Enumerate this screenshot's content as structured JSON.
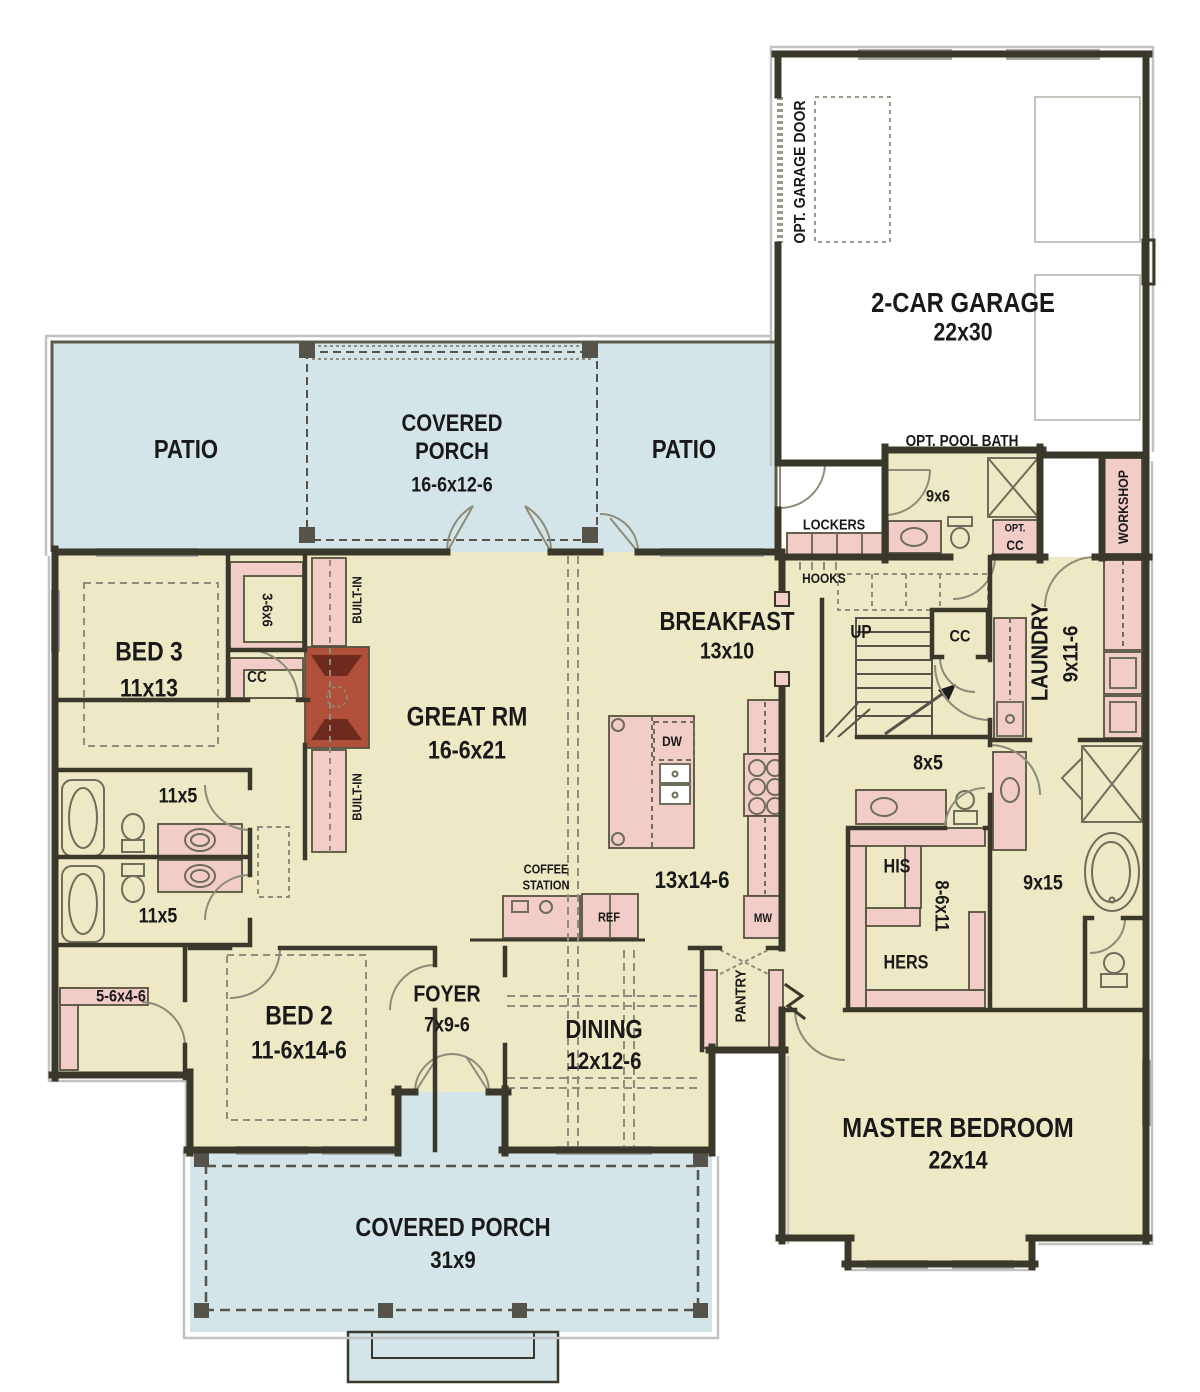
{
  "palette": {
    "floor": "#ece9c4",
    "porch_blue": "#d3e5e9",
    "fixture_pink": "#f2cdc7",
    "brick_red": "#b0503a",
    "brick_dark": "#6e2a1c",
    "wall": "#3a382a",
    "window_gray": "#a9a9a9",
    "trim_gray": "#c2c2c2",
    "label": "#191919"
  },
  "labels": {
    "opt_garage_door": "OPT. GARAGE DOOR",
    "garage": "2-CAR GARAGE",
    "garage_dims": "22x30",
    "patio_left": "PATIO",
    "patio_right": "PATIO",
    "porch_top_1": "COVERED",
    "porch_top_2": "PORCH",
    "porch_top_dims": "16-6x12-6",
    "pool_bath": "OPT. POOL BATH",
    "pool_bath_dims": "9x6",
    "lockers": "LOCKERS",
    "opt_small": "OPT.",
    "opt_cc": "CC",
    "hooks": "HOOKS",
    "workshop": "WORKSHOP",
    "breakfast": "BREAKFAST",
    "breakfast_dims": "13x10",
    "up": "UP",
    "stair_cc": "CC",
    "laundry": "LAUNDRY",
    "laundry_dims": "9x11-6",
    "closet_3_6": "3-6x6",
    "bed3": "BED 3",
    "bed3_dims": "11x13",
    "bed3_cc": "CC",
    "builtin_top": "BUILT-IN",
    "builtin_bottom": "BUILT-IN",
    "great": "GREAT RM",
    "great_dims": "16-6x21",
    "bath_upper_dims": "11x5",
    "bath_lower_dims": "11x5",
    "closet_5_6": "5-6x4-6",
    "bed2": "BED 2",
    "bed2_dims": "11-6x14-6",
    "foyer": "FOYER",
    "foyer_dims": "7x9-6",
    "dining": "DINING",
    "dining_dims": "12x12-6",
    "coffee_1": "COFFEE",
    "coffee_2": "STATION",
    "ref": "REF",
    "kitchen_dims": "13x14-6",
    "dw": "DW",
    "mw": "MW",
    "pantry": "PANTRY",
    "hall_dims": "8x5",
    "his": "HIS",
    "hers": "HERS",
    "wic_dims": "8-6x11",
    "master_bath_dims": "9x15",
    "master": "MASTER BEDROOM",
    "master_dims": "22x14",
    "porch_bottom": "COVERED PORCH",
    "porch_bottom_dims": "31x9"
  }
}
